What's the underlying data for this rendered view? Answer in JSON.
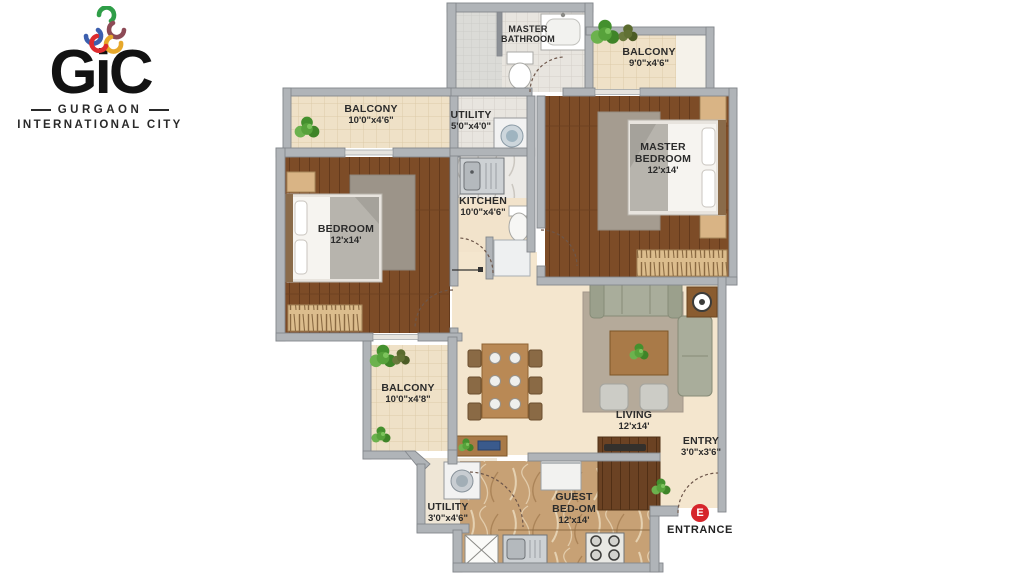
{
  "logo": {
    "brand": "GiC",
    "line1": "GURGAON",
    "line2": "INTERNATIONAL CITY"
  },
  "rooms": {
    "master_bathroom": {
      "lines": [
        "MASTER",
        "BATHROOM"
      ],
      "dim": ""
    },
    "balcony_top_right": {
      "lines": [
        "BALCONY"
      ],
      "dim": "9'0\"x4'6\""
    },
    "utility_top": {
      "lines": [
        "UTILITY"
      ],
      "dim": "5'0\"x4'0\""
    },
    "kitchen": {
      "lines": [
        "KITCHEN"
      ],
      "dim": "10'0\"x4'6\""
    },
    "master_bedroom": {
      "lines": [
        "MASTER",
        "BEDROOM"
      ],
      "dim": "12'x14'"
    },
    "bedroom": {
      "lines": [
        "BEDROOM"
      ],
      "dim": "12'x14'"
    },
    "balcony_top_left": {
      "lines": [
        "BALCONY"
      ],
      "dim": "10'0\"x4'6\""
    },
    "balcony_bottom_left": {
      "lines": [
        "BALCONY"
      ],
      "dim": "10'0\"x4'8\""
    },
    "living": {
      "lines": [
        "LIVING"
      ],
      "dim": "12'x14'"
    },
    "entry": {
      "lines": [
        "ENTRY"
      ],
      "dim": "3'0\"x3'6\""
    },
    "guest_bedroom": {
      "lines": [
        "GUEST",
        "BED-OM"
      ],
      "dim": "12'x14'"
    },
    "utility_bottom": {
      "lines": [
        "UTILITY"
      ],
      "dim": "3'0\"x4'6\""
    }
  },
  "entrance": {
    "marker": "E",
    "label": "ENTRANCE"
  },
  "colors": {
    "accent_red": "#d6252b",
    "wall_gray": "#b0b4b8",
    "wood_floor": "#7d4c27",
    "tile_floor": "#efe1c7",
    "beige_floor": "#f4e6ce",
    "marble_floor": "#c7a175",
    "sofa_green": "#a9ad9b",
    "logo_green": "#2f9e48",
    "logo_blue": "#3c5fae",
    "logo_yellow": "#e7a82b",
    "logo_red": "#dd2b2f",
    "logo_maroon": "#8d4a56"
  }
}
